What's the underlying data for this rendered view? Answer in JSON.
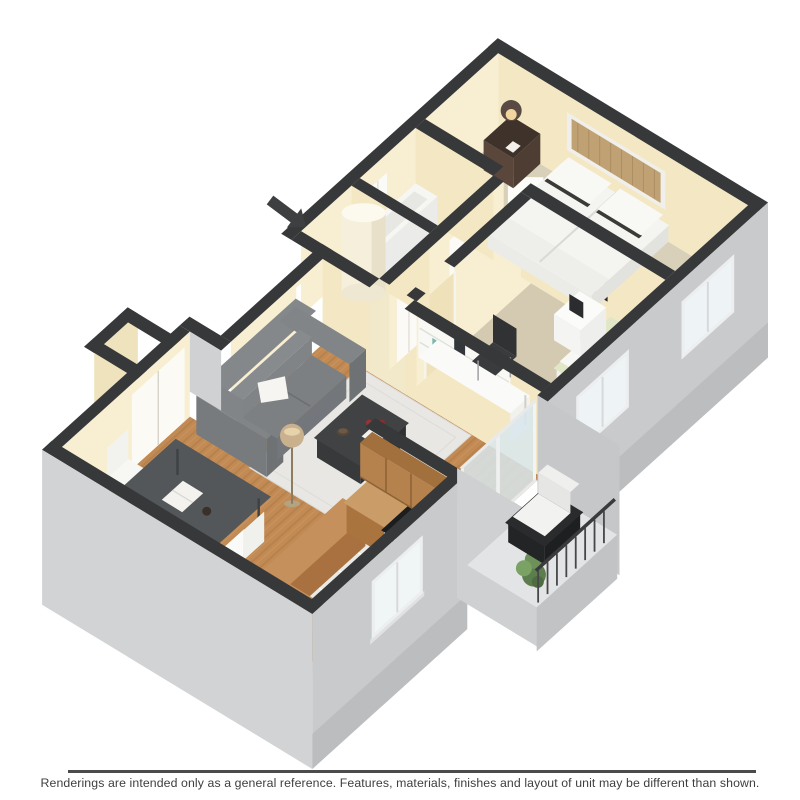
{
  "image": {
    "type": "3d-floor-plan-rendering",
    "view": "isometric",
    "rooms": [
      "living-room",
      "dining-area",
      "kitchen",
      "balcony",
      "hallway",
      "utility-closet",
      "bathroom",
      "office-bedroom",
      "master-bedroom",
      "entry-nook"
    ],
    "furniture": [
      "sofa",
      "area-rug",
      "coffee-table",
      "floor-lamp",
      "dining-table",
      "dining-chairs",
      "breakfast-bar",
      "kitchen-cabinets",
      "stove",
      "water-heater",
      "bathtub",
      "bed",
      "pillows",
      "nightstand",
      "table-lamp",
      "wall-mirror",
      "desk",
      "desk-hutch",
      "desk-chair",
      "wall-art",
      "daybed",
      "white-nightstand",
      "balcony-chair",
      "potted-plant",
      "balcony-railing",
      "sliding-glass-door",
      "entry-arrow"
    ]
  },
  "footer": {
    "disclaimer": "Renderings are intended only as a general reference. Features, materials, finishes and layout of unit may be different than shown."
  },
  "palette": {
    "wall_dark": "#37383a",
    "wall_cream_bright": "#f8efd2",
    "wall_cream_side": "#f4e8c4",
    "floor_cream": "#f2e9cb",
    "hardwood": "#c28a54",
    "hardwood_streak": "#a9773f",
    "tile": "#eae9e3",
    "carpet_office": "#d3cab1",
    "carpet_bedroom": "#d8d0b8",
    "exterior_gray_sw": "#d2d3d5",
    "exterior_gray_se": "#c9cacc",
    "exterior_gray_dark": "#bcbdbf",
    "window_glass": "#f0f5f6",
    "sliding_glass": "#d8e6ec",
    "sofa_gray": "#7d8083",
    "rug_white": "#e8e7e3",
    "table_charcoal": "#404244",
    "dining_table": "#54575a",
    "chair_white": "#fafaf8",
    "counter_wood": "#c6905c",
    "cabinet_wood": "#b5814d",
    "cabinet_front": "#a8713f",
    "stove_top": "#1c1d1e",
    "bed_white": "#f4f4f1",
    "daybed_green": "#e1e7c6",
    "plant_green": "#5c7d4c",
    "lamp_bronze": "#5a4a44",
    "arrow_dark": "#3e3f41",
    "accent_red": "#9c3134",
    "footer_line": "#4b4b4b",
    "footer_text": "#3e3e3e"
  }
}
